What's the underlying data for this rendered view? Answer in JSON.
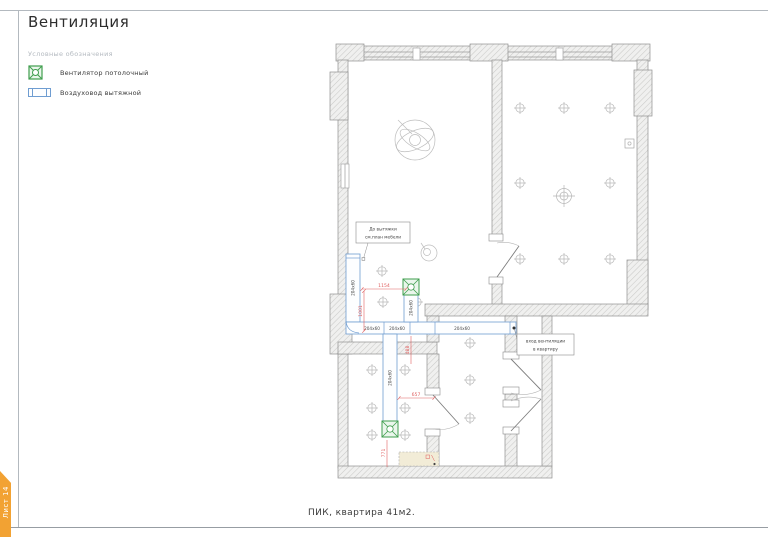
{
  "colors": {
    "fan-green": "#3f9e4e",
    "fan-green-fill": "#eaf6ec",
    "duct-blue": "#6f9dd1",
    "dim-red": "#e06060",
    "tab-orange": "#f2a233",
    "wall-stroke": "#8f8f8f",
    "sketch-gray": "#bdbdbd",
    "frame-gray": "#b3b9bf",
    "text-dark": "#3a3a3a"
  },
  "header": {
    "title": "Вентиляция"
  },
  "legend": {
    "header": "Условные обозначения",
    "items": [
      {
        "label": "Вентилятор потолочный"
      },
      {
        "label": "Воздуховод вытяжной"
      }
    ]
  },
  "plan": {
    "callout_hood": {
      "line1": "До вытяжки",
      "line2": "см.план мебели"
    },
    "callout_entry": {
      "line1": "вход вентиляции",
      "line2": "в квартиру"
    },
    "ducts": {
      "v1": "204x60",
      "h1a": "204x60",
      "h1b": "204x60",
      "h2": "204x60",
      "v2": "204x60",
      "v3": "204x60"
    },
    "dims": {
      "d1154": "1154",
      "d1001": "1001",
      "d488": "488",
      "d657": "657",
      "d771": "771"
    }
  },
  "footer": {
    "caption": "ПИК, квартира 41м2.",
    "sheet_tab": "Лист 14"
  }
}
